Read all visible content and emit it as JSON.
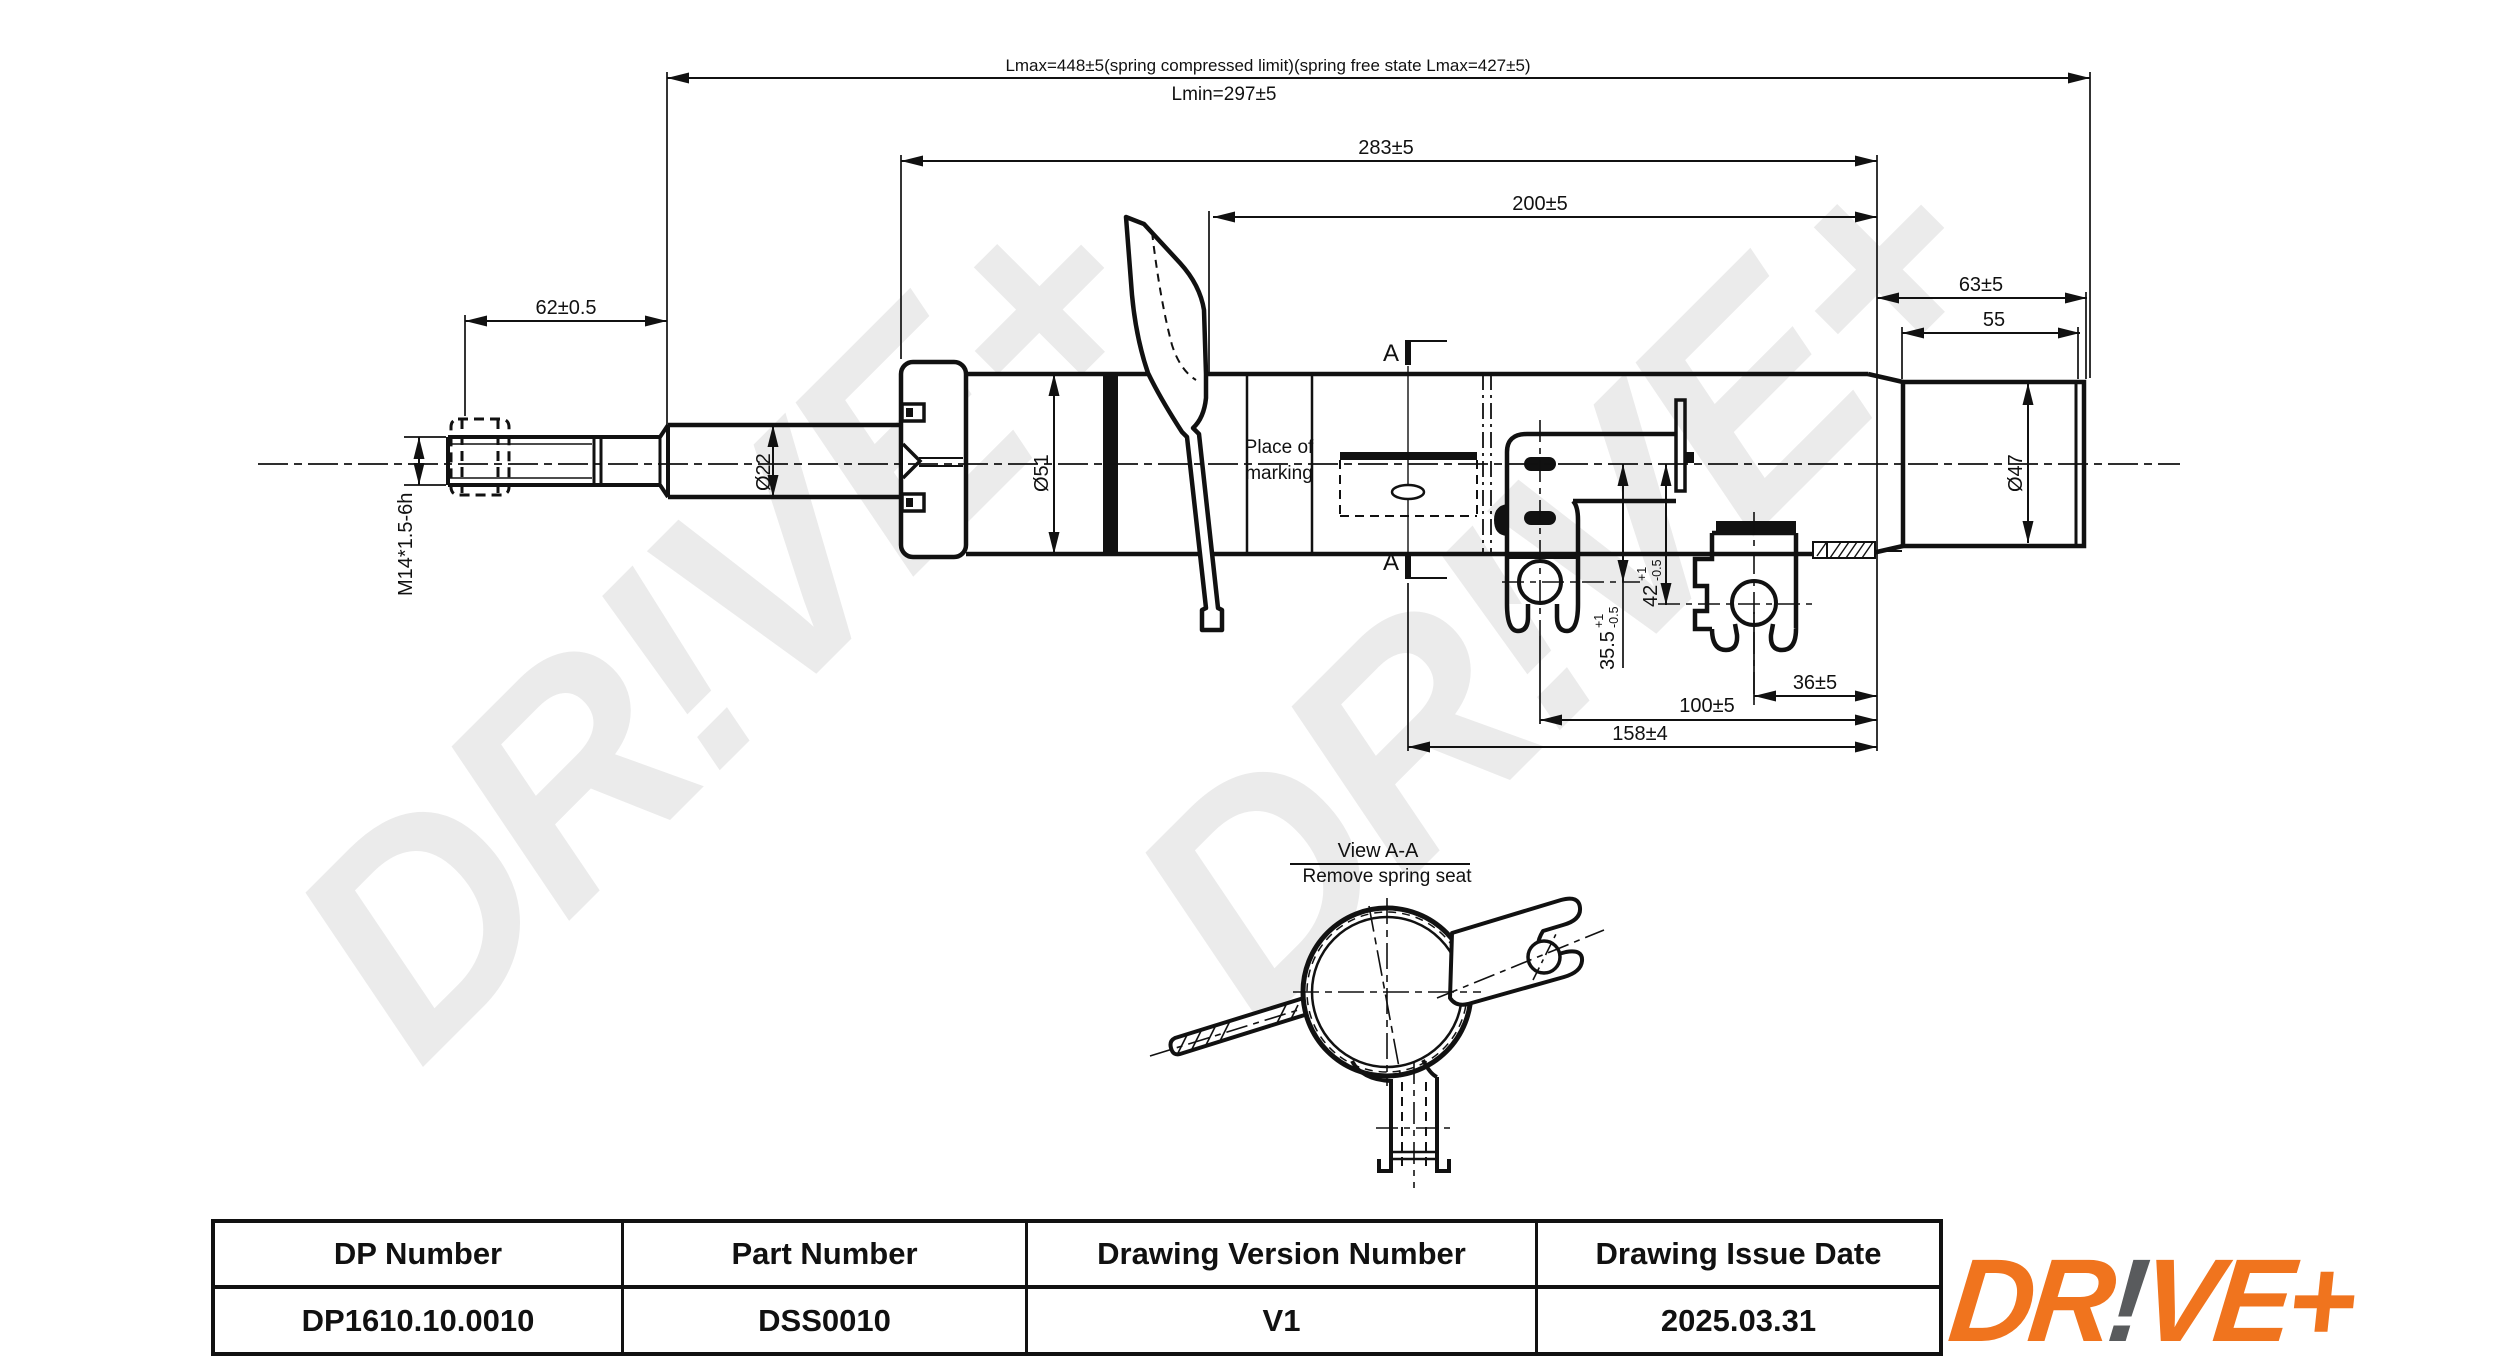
{
  "watermark": {
    "text": "DR!VE+"
  },
  "drawing": {
    "dims": {
      "lmax": "Lmax=448±5(spring compressed limit)(spring free state Lmax=427±5)",
      "lmin": "Lmin=297±5",
      "d283": "283±5",
      "d200": "200±5",
      "d62": "62±0.5",
      "d63": "63±5",
      "d55": "55",
      "m14": "M14*1.5-6h",
      "dia22": "Ø22",
      "dia51": "Ø51",
      "dia47": "Ø47",
      "d355": {
        "value": "35.5",
        "tol_plus": "+1",
        "tol_minus": "-0.5"
      },
      "d42": {
        "value": "42",
        "tol_plus": "+1",
        "tol_minus": "-0.5"
      },
      "d36": "36±5",
      "d100": "100±5",
      "d158": "158±4"
    },
    "labels": {
      "place_of_marking_line1": "Place of",
      "place_of_marking_line2": "marking",
      "section_letter": "A",
      "view_title": "View A-A",
      "view_subtitle": "Remove spring seat"
    }
  },
  "title_block": {
    "headers": [
      "DP Number",
      "Part Number",
      "Drawing Version Number",
      "Drawing Issue Date"
    ],
    "values": [
      "DP1610.10.0010",
      "DSS0010",
      "V1",
      "2025.03.31"
    ]
  },
  "logo": {
    "part1": "DR",
    "excl": "!",
    "part2": "VE+"
  },
  "colors": {
    "accent_orange": "#F0741E",
    "logo_gray": "#595B5D",
    "watermark_gray": "#EBEBEB",
    "line_black": "#111111"
  }
}
